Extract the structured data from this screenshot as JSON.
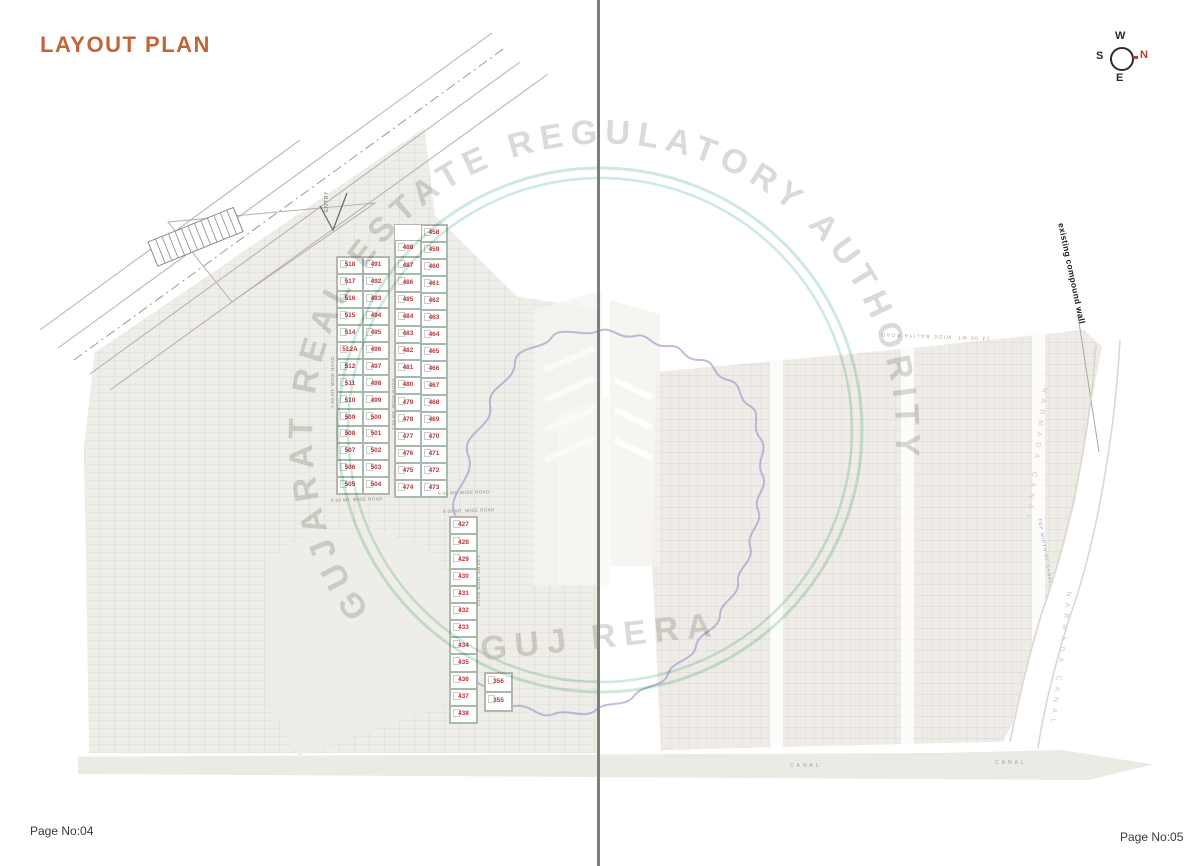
{
  "title": "LAYOUT PLAN",
  "pages": {
    "left": "Page No:04",
    "right": "Page No:05"
  },
  "compass": {
    "n": "N",
    "s": "S",
    "e": "E",
    "w": "W"
  },
  "watermark": {
    "ring_text": "GUJARAT REAL ESTATE REGULATORY AUTHORITY",
    "center_text": "GUJ RERA",
    "ring_color": "#a5d8bc",
    "text_color": "#9fa89e",
    "map_outline_color": "#9094c5"
  },
  "colors": {
    "title": "#c2653a",
    "plot_number": "#c23434",
    "field": "#efede8",
    "canal_band": "#eceae5",
    "canal_text_blue": "#9094c5"
  },
  "strips": {
    "stripA": {
      "colLeft": [
        "518",
        "517",
        "516",
        "515",
        "514",
        "512A",
        "512",
        "511",
        "510",
        "509",
        "508",
        "507",
        "506",
        "505"
      ],
      "colRight": [
        "491",
        "492",
        "493",
        "494",
        "495",
        "496",
        "497",
        "498",
        "499",
        "500",
        "501",
        "502",
        "503",
        "504"
      ]
    },
    "stripB": {
      "colLeft": [
        null,
        "488",
        "487",
        "486",
        "485",
        "484",
        "483",
        "482",
        "481",
        "480",
        "479",
        "478",
        "477",
        "476",
        "475",
        "474"
      ],
      "colRight": [
        "458",
        "459",
        "460",
        "461",
        "462",
        "463",
        "464",
        "465",
        "466",
        "467",
        "468",
        "469",
        "470",
        "471",
        "472",
        "473"
      ]
    },
    "stripC": {
      "col": [
        "427",
        "428",
        "429",
        "430",
        "431",
        "432",
        "433",
        "434",
        "435",
        "436",
        "437",
        "438"
      ]
    },
    "block": {
      "col": [
        "356",
        "355"
      ]
    }
  },
  "road_labels": {
    "below_strip_a": "9.00 MT. WIDE ROAD",
    "below_strip_b": "9.00 MT. WIDE ROAD",
    "above_strip_c": "9.00 MT. WIDE ROAD",
    "strip_a_vertical": "7.50 MT. WIDE ROAD",
    "strip_b_vertical": "7.50 MT. WIDE ROAD",
    "strip_c_vertical": "7.50 MT. WIDE ROAD",
    "baliya_road": "24.00 MT. WIDE BALIYA ROAD"
  },
  "annotations": {
    "entry": "ENTRY",
    "compound_wall": "existing compound wall",
    "narmada_canal": "NARMADA CANAL",
    "top_width_of_canal": "TOP WIDTH OF CANAL",
    "canal": "CANAL"
  }
}
